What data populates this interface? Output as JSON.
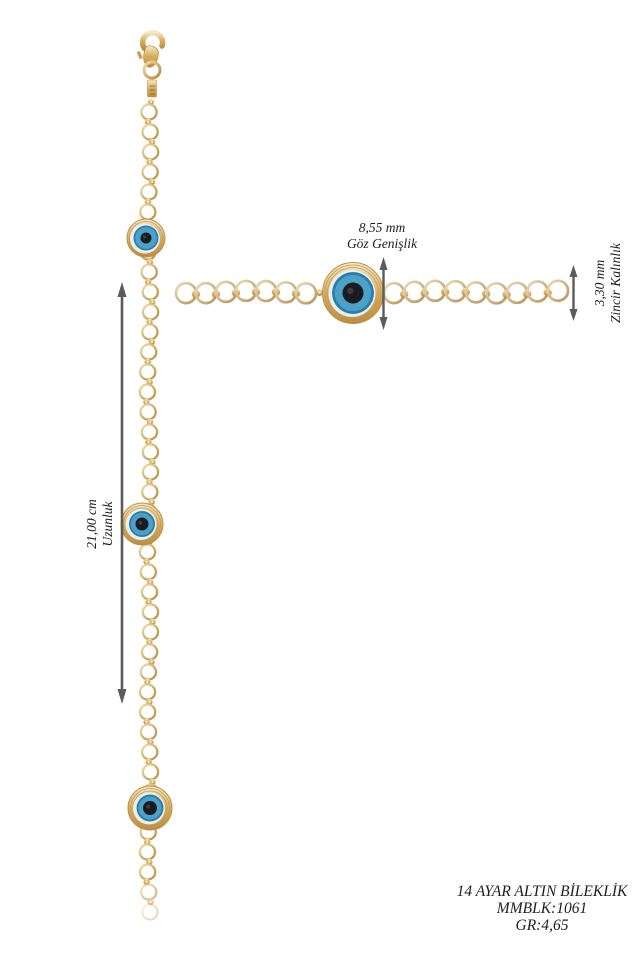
{
  "annotations": {
    "eye_width": {
      "value": "8,55 mm",
      "label": "Göz Genişlik"
    },
    "chain_thickness": {
      "value": "3,30 mm",
      "label": "Zincir Kalınlık"
    },
    "length": {
      "value": "21,00 cm",
      "label": "Uzunluk"
    }
  },
  "product": {
    "title": "14 AYAR ALTIN BİLEKLİK",
    "code": "MMBLK:1061",
    "weight": "GR:4,65"
  },
  "colors": {
    "background": "#ffffff",
    "gold": "#d2ab64",
    "gold_light": "#f0e0b4",
    "gold_dark": "#b98f47",
    "gold_pale": "#cfb382",
    "eye_blue": "#4ba1c8",
    "eye_blue_dark": "#2a7ea8",
    "eye_white": "#eceeed",
    "eye_pupil": "#1b1b22",
    "arrow": "#5b5b5b",
    "text": "#1d1d1d"
  }
}
